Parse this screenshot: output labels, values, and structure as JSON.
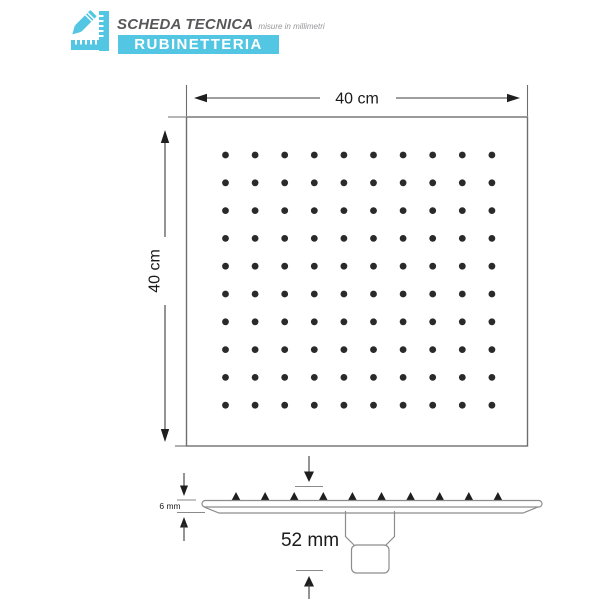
{
  "header": {
    "title": "SCHEDA TECNICA",
    "subtitle": "misure in millimetri",
    "banner": "RUBINETTERIA",
    "icon": "ruler-pencil-icon"
  },
  "colors": {
    "accent": "#52c6e2",
    "plan_border": "#6e6e6e",
    "profile_outline": "#8c8c8c",
    "dimension": "#3d3d3d",
    "tick": "#8a8a8a",
    "dot": "#2a2a2a"
  },
  "plan_view": {
    "width_label": "40 cm",
    "height_label": "40 cm",
    "nozzle_grid": {
      "rows": 10,
      "cols": 10
    }
  },
  "side_view": {
    "thickness_label": "6 mm",
    "connector_label": "52 mm",
    "nozzle_count": 10
  }
}
